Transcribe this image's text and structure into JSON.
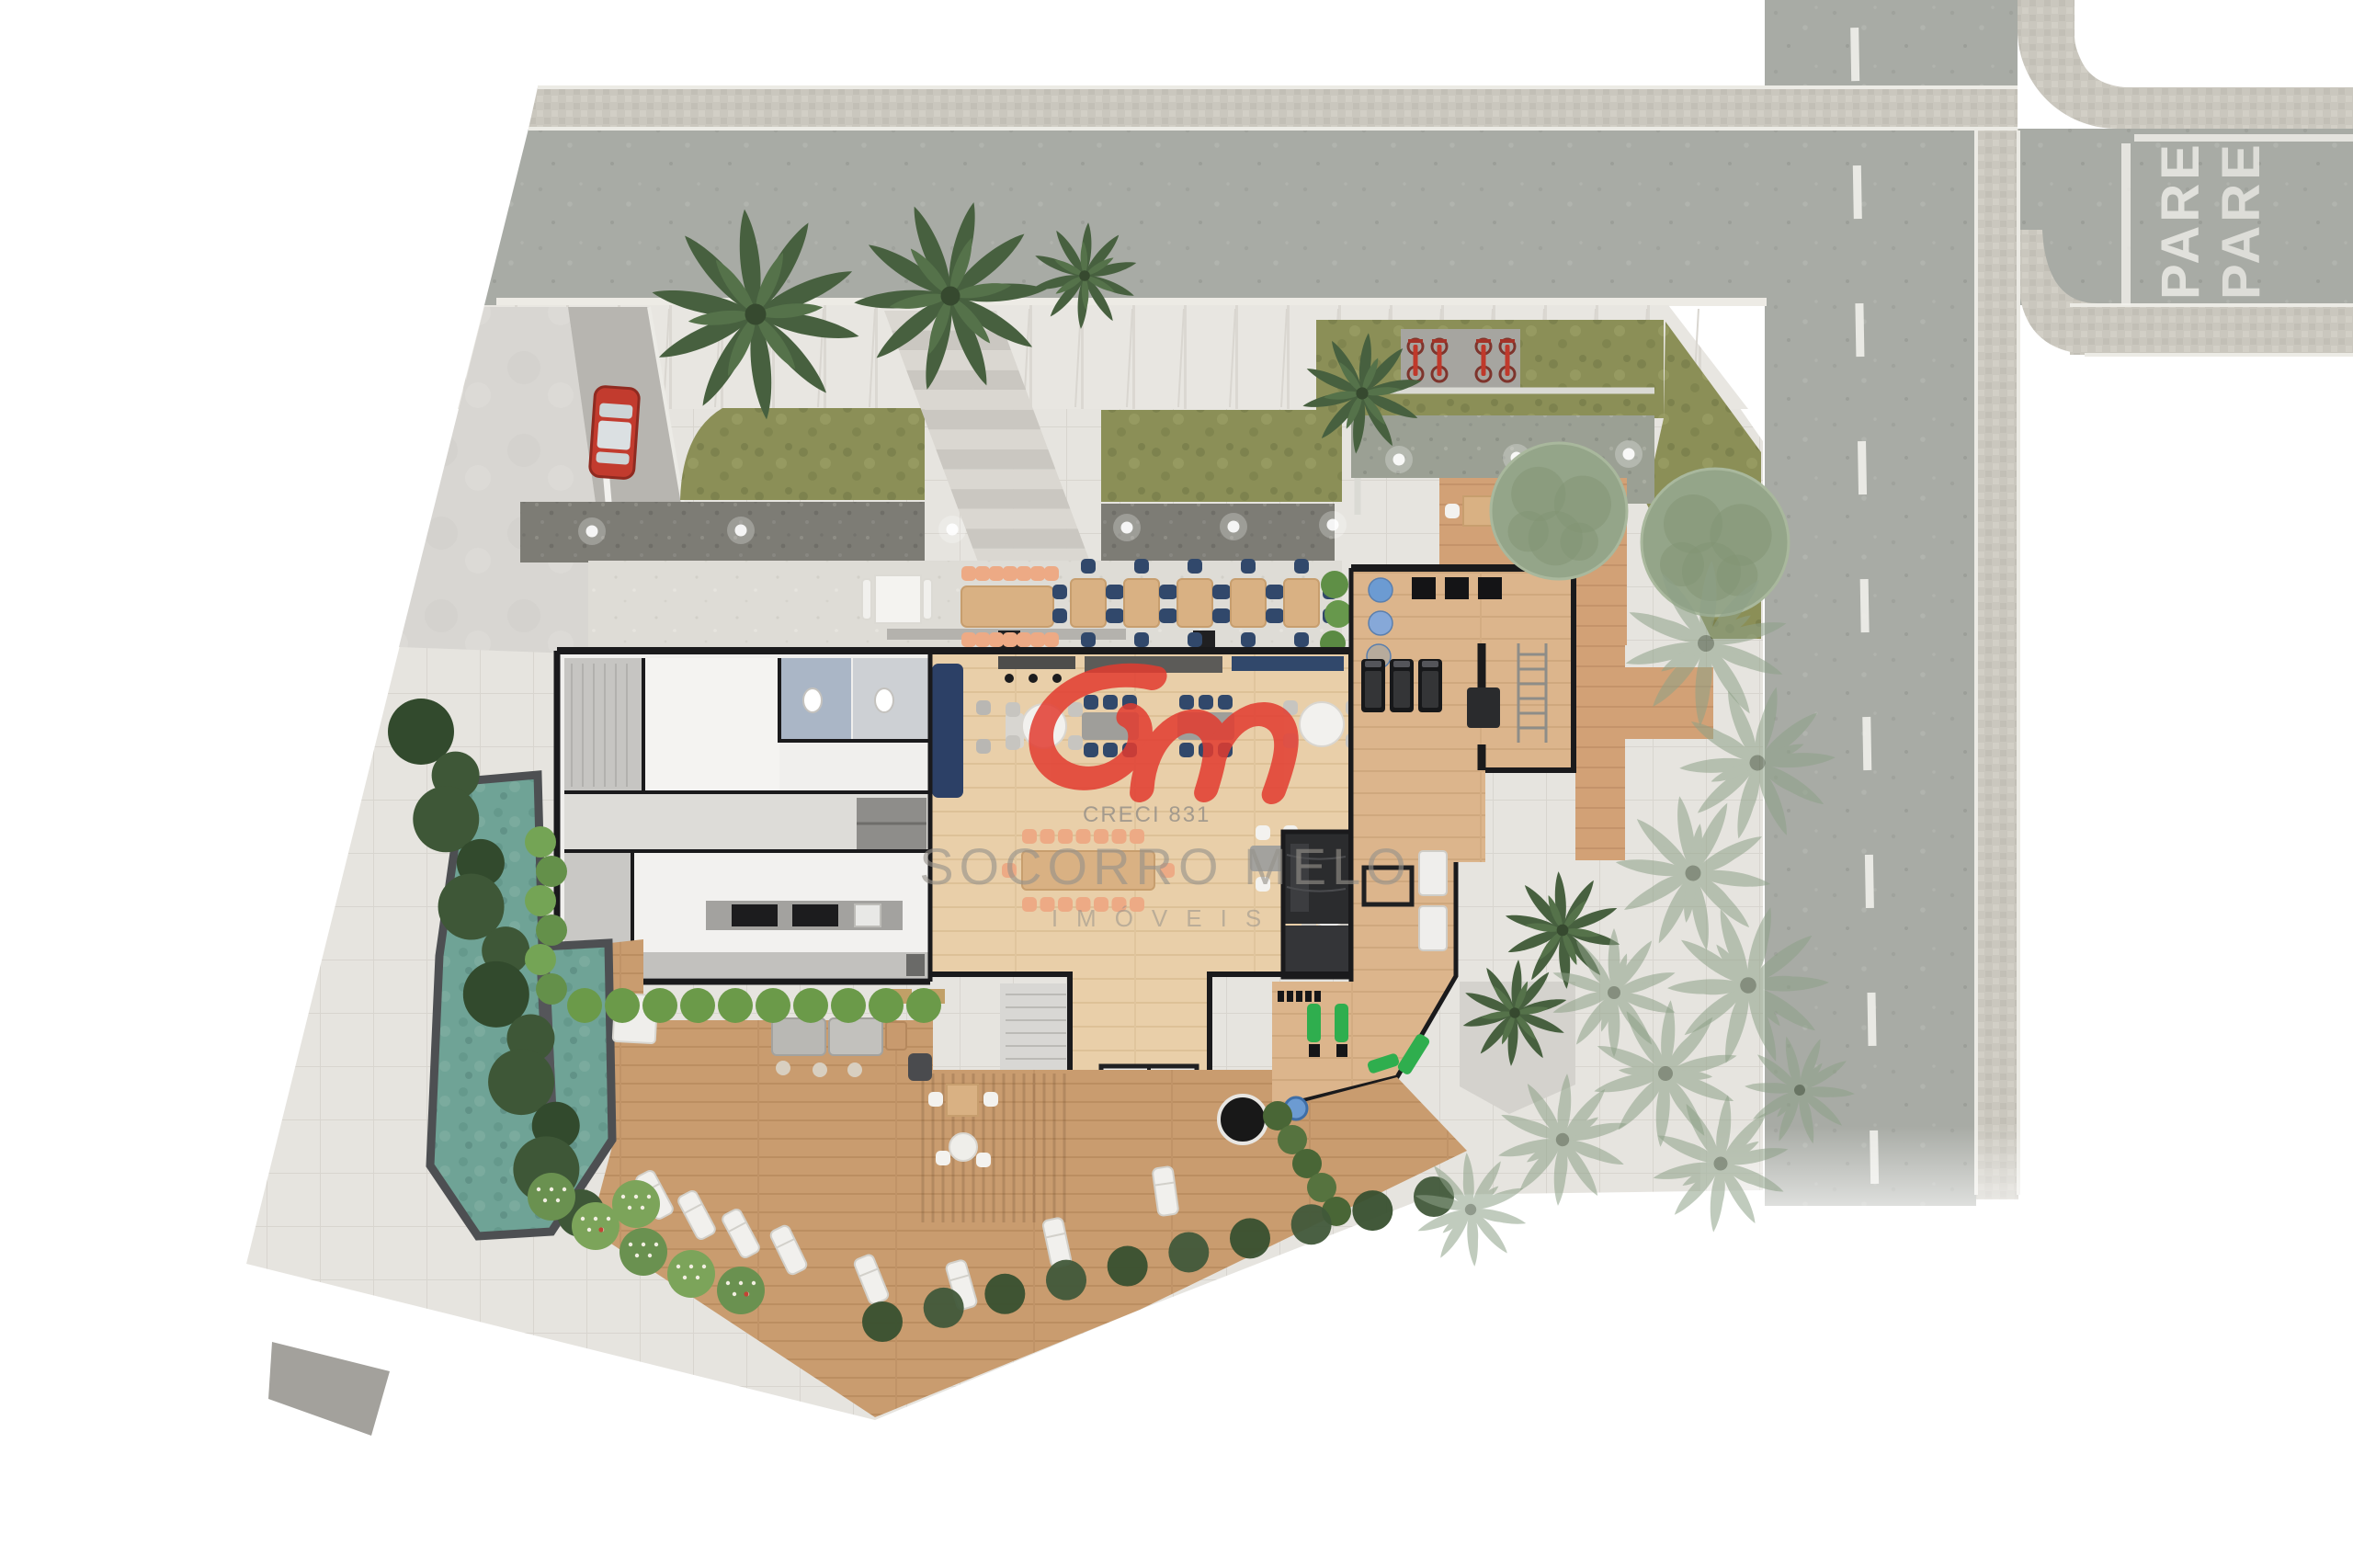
{
  "meta": {
    "title": "Residential development ground-floor site plan (top-down architectural rendering)",
    "view": "aerial top-down"
  },
  "watermark": {
    "creci": "CRECI 831",
    "name": "SOCORRO MELO",
    "subtitle": "IMÓVEIS",
    "logo_icon": "sm-monogram-logo",
    "logo_color": "#e23c30",
    "text_color": "#938f88"
  },
  "streets": {
    "stop_marking": "PARE",
    "stop_marking_repeat": 2,
    "lane_dash_count": 9,
    "lane_dash_color": "#f4f3ee",
    "asphalt_color": "#a8aba5",
    "paver_color": "#cac7be",
    "curb_color": "#ecebe5"
  },
  "site": {
    "stair_tread_count": 14,
    "sidewalk_color": "#e7e5e0",
    "lawn_color": "#8b8f57",
    "gravel_color": "#7d7c75",
    "terrace_color": "#dedcd6",
    "pool_color": "#6fa396",
    "deck_color": "#c99c6f",
    "lounge_wood_color": "#e9cfa9",
    "gym_wood_color": "#dcb58c",
    "hedge_dark_color": "#3e5737",
    "hedge_bright_color": "#6b9a49"
  },
  "legend_counts": {
    "terrace_tables": 5,
    "terrace_long_table_chairs": 14,
    "lounge_long_table_chairs": 14,
    "lounge_round_tables": 2,
    "lounge_rect_tables": 2,
    "treadmills": 3,
    "gym_balls": 3,
    "parked_bikes": 4,
    "sun_loungers": 8,
    "cars": 1,
    "north_palm_trees": 3,
    "garden_round_trees": 2,
    "gravel_path_lights": 6,
    "ne_garden_lights": 3
  },
  "palette": {
    "car_red": "#c23b2e",
    "bike_red": "#c0392b",
    "navy_chair": "#31486b",
    "peach_chair": "#edaa85",
    "table_wood": "#d9b183",
    "equipment_green": "#2fae4e",
    "ball_blue": "#6c9bd2",
    "wall_black": "#1a1a1c"
  }
}
